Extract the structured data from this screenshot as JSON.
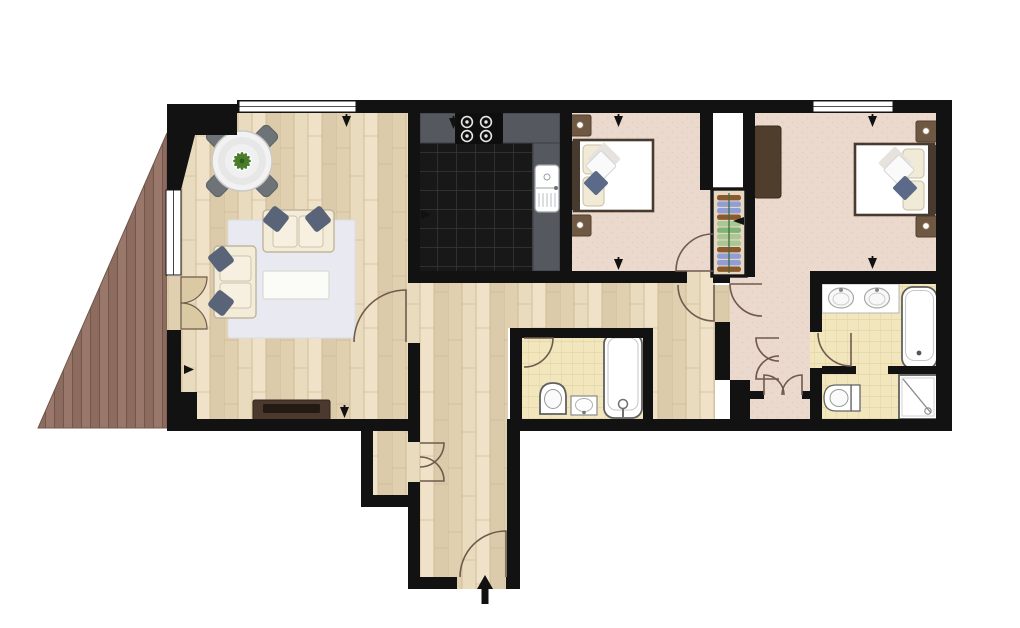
{
  "scene": {
    "type": "floor-plan",
    "description": "Top-down colour floor plan of a two bedroom, two bathroom apartment with a triangular timber deck, open living/dining room, dark-tiled kitchen, hallway and entrance hall",
    "entry_marker": "black arrow pointing up at the entrance door",
    "window_count": 3,
    "small_direction_arrows": 9
  },
  "colors": {
    "wall": "#121212",
    "outline": "#6f5b4d",
    "wood_a": "#e9dbbe",
    "wood_b": "#e0d0b0",
    "wood_c": "#efe2c8",
    "wood_d": "#dccbab",
    "wood_line": "#c8b28c",
    "deck_a": "#9a776b",
    "deck_b": "#8d6b5e",
    "deck_line": "#72574a",
    "carpet": "#ead9cc",
    "carpet_dot": "#dfccbd",
    "kitchen_tile": "#181818",
    "kitchen_tile_line": "#3e3e3e",
    "counter": "#55595f",
    "counter_edge": "#3c4045",
    "hob": "#0e0e0e",
    "bath_tile": "#f2e6bd",
    "bath_tile_line": "#dccf9f",
    "fixture": "#606060",
    "fixture_light": "#c9c9c9",
    "rug": "#e9e9f1",
    "sofa": "#f3ecd9",
    "sofa_edge": "#c2b59c",
    "cushion": "#5a6478",
    "table": "#f2f2f2",
    "chair": "#6e7377",
    "plant": "#4a7d2b",
    "door_leaf": "#dbc9a4",
    "tv_unit": "#4a392c",
    "tv_screen": "#221a13",
    "bed_frame": "#473b2f",
    "bedding": "#f1ead6",
    "throw": "#5b6a89",
    "nightstand": "#6e5743",
    "wardrobe": "#503e2c",
    "closet_blue": "#8f9ed6",
    "closet_brown": "#8a5a2e",
    "closet_sage": "#a9c695",
    "closet_green": "#7fb574",
    "closet_pole": "#3f6b3f",
    "arrow": "#111111"
  },
  "rooms": [
    {
      "name": "decking",
      "floor": "timber deck boards",
      "furniture": []
    },
    {
      "name": "living-dining-room",
      "floor": "light wood",
      "furniture": [
        "round dining table",
        "4 dining chairs",
        "potted plant centrepiece",
        "two-seat sofa",
        "second sofa",
        "4 scatter cushions",
        "area rug",
        "coffee table",
        "tv-media-unit"
      ]
    },
    {
      "name": "kitchen",
      "floor": "black tiles",
      "furniture": [
        "worktop",
        "four-ring hob",
        "sink with drainer"
      ]
    },
    {
      "name": "bedroom-1",
      "floor": "carpet",
      "furniture": [
        "double bed",
        "2 bedside tables",
        "built-in wardrobe with clothes shelves"
      ]
    },
    {
      "name": "bedroom-2",
      "floor": "carpet",
      "furniture": [
        "double bed",
        "2 bedside tables",
        "wardrobe"
      ]
    },
    {
      "name": "bathroom",
      "floor": "cream tiles",
      "furniture": [
        "bathtub with tap",
        "toilet",
        "washbasin"
      ]
    },
    {
      "name": "ensuite-bathroom",
      "floor": "cream tiles",
      "furniture": [
        "double vanity basins",
        "bathtub",
        "shower enclosure",
        "toilet"
      ]
    },
    {
      "name": "hallway",
      "floor": "light wood",
      "furniture": []
    },
    {
      "name": "entrance-hall",
      "floor": "light wood",
      "furniture": [
        "entry door with swing arc",
        "entry direction arrow"
      ]
    },
    {
      "name": "inner-lobby",
      "floor": "carpet",
      "furniture": [
        "double cupboard doors"
      ]
    },
    {
      "name": "hall-cupboard",
      "floor": "light wood",
      "furniture": [
        "double doors"
      ]
    }
  ],
  "closet_stack_colors": [
    "#8a5a2e",
    "#8f9ed6",
    "#8f9ed6",
    "#8a5a2e",
    "#a9c695",
    "#7fb574",
    "#a9c695",
    "#a9c695",
    "#8a5a2e",
    "#8f9ed6",
    "#8f9ed6",
    "#8a5a2e"
  ]
}
